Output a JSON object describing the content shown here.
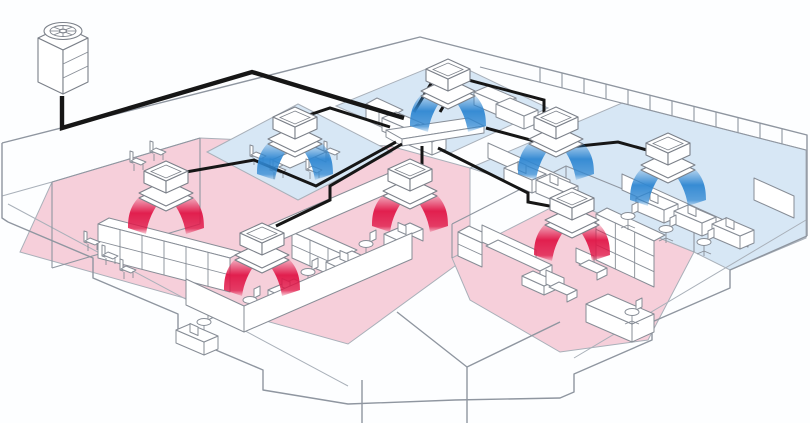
{
  "diagram": {
    "kind": "office-vrf-air-conditioning-isometric",
    "colors": {
      "bg": "#fdfeff",
      "line": "#8f96a0",
      "line_soft": "#a9b0b9",
      "furn_line": "#878d96",
      "furn_fill": "#ffffff",
      "pipe": "#161616",
      "cool_zone": "#d7e7f5",
      "heat_zone": "#f6cfda",
      "cool_air": "#2f87d2",
      "heat_air": "#e01647",
      "unit_body": "#ffffff",
      "unit_line": "#7b8089"
    },
    "building": {
      "outline": [
        "M2,143 L420,37 L807,135 L807,236",
        "M807,236 L730,270 L730,288 L652,322 L652,340 L574,374 L574,392 L560,398 L455,400",
        "M8,222 L93,258 L93,278 L178,314 L178,334 L263,370 L263,390 L348,404 L455,400",
        "M2,143 L2,218 L8,222",
        "M397,312 L467,367 L560,322",
        "M467,367 L467,423",
        "M362,380 L362,423"
      ],
      "outline_soft": [
        "M8,204 L348,386",
        "M806,220 L574,358",
        "M2,196 L52,182"
      ],
      "wall_lines": [
        "M52,182 L200,138",
        "M52,182 L52,268",
        "M200,138 L200,224",
        "M52,268 L200,224",
        "M452,224 L566,166 L694,218",
        "M452,224 L452,258",
        "M566,166 L566,200",
        "M694,218 L694,252",
        "M480,67 L806,150"
      ],
      "mullions": {
        "x_start": 540,
        "x_end": 792,
        "step": 22,
        "len": 15,
        "y0": 37,
        "x0": 420,
        "slope": 0.253
      }
    },
    "zones": [
      {
        "id": "heating-open-office",
        "mode": "heating",
        "points": "52,182 200,138 390,146 470,168 470,255 348,344 20,252"
      },
      {
        "id": "heating-lounge",
        "mode": "heating",
        "points": "452,258 566,200 694,252 648,340 560,352 470,300"
      },
      {
        "id": "cooling-meeting-room",
        "mode": "cooling",
        "points": "207,152 298,104 392,152 298,200"
      },
      {
        "id": "cooling-top-room",
        "mode": "cooling",
        "points": "336,106 448,60 548,108 448,154"
      },
      {
        "id": "cooling-right-wing",
        "mode": "cooling",
        "points": "470,168 622,103 806,150 806,238 730,270 694,252 566,200"
      }
    ],
    "outdoor_unit": {
      "x": 63,
      "y": 30
    },
    "manifold": {
      "top": "386,130 468,118 484,126 402,139",
      "front": "402,139 484,126 484,133 402,146",
      "side": "386,130 402,139 402,146 386,137"
    },
    "pipes": {
      "main": "M62,96 L62,128 L252,72 L404,118",
      "branches": [
        "M440,112 L452,92 L450,80",
        "M390,127 L330,108 L300,118",
        "M414,112 L438,72 L544,100 L544,114 L556,122",
        "M486,128 L560,148 L618,142 L654,152",
        "M396,142 L316,186 L254,160 L186,172",
        "M402,144 L330,186 L330,200 L276,226",
        "M422,146 L422,166 L414,170",
        "M438,148 L528,193 L528,202 L560,208"
      ]
    },
    "indoor_units": [
      {
        "id": "u1",
        "mode": "cooling",
        "x": 448,
        "y": 86
      },
      {
        "id": "u2",
        "mode": "cooling",
        "x": 295,
        "y": 134
      },
      {
        "id": "u3",
        "mode": "cooling",
        "x": 556,
        "y": 134
      },
      {
        "id": "u4",
        "mode": "cooling",
        "x": 668,
        "y": 160
      },
      {
        "id": "u5",
        "mode": "heating",
        "x": 166,
        "y": 188
      },
      {
        "id": "u6",
        "mode": "heating",
        "x": 262,
        "y": 250
      },
      {
        "id": "u7",
        "mode": "heating",
        "x": 410,
        "y": 186
      },
      {
        "id": "u8",
        "mode": "heating",
        "x": 572,
        "y": 215
      }
    ],
    "furniture": [
      {
        "t": "shelf",
        "x": 98,
        "y": 224,
        "dx": 132,
        "dy": 34,
        "h": 34,
        "c": 6,
        "r": 2
      },
      {
        "t": "shelf",
        "x": 292,
        "y": 232,
        "dx": 54,
        "dy": 24,
        "h": 26,
        "c": 3,
        "r": 2
      },
      {
        "t": "shelf",
        "x": 596,
        "y": 214,
        "dx": 58,
        "dy": 27,
        "h": 46,
        "c": 3,
        "r": 3
      },
      {
        "t": "shelf",
        "x": 458,
        "y": 232,
        "dx": 24,
        "dy": 11,
        "h": 24,
        "c": 1,
        "r": 2
      },
      {
        "t": "shelf",
        "x": 366,
        "y": 104,
        "dx": 26,
        "dy": 12,
        "h": 16,
        "c": 2,
        "r": 1
      },
      {
        "t": "panel",
        "x": 244,
        "y": 332,
        "dx": 168,
        "dy": -73,
        "h": 26
      },
      {
        "t": "panel",
        "x": 244,
        "y": 332,
        "dx": -58,
        "dy": -27,
        "h": 26
      },
      {
        "t": "panel",
        "x": 258,
        "y": 250,
        "dx": 138,
        "dy": -60,
        "h": 20
      },
      {
        "t": "panel",
        "x": 622,
        "y": 190,
        "dx": 126,
        "dy": 57,
        "h": 16
      },
      {
        "t": "panel",
        "x": 754,
        "y": 200,
        "dx": 40,
        "dy": 18,
        "h": 22
      },
      {
        "t": "panel",
        "x": 488,
        "y": 158,
        "dx": 82,
        "dy": 37,
        "h": 15
      },
      {
        "t": "desk",
        "x": 268,
        "y": 290
      },
      {
        "t": "desk",
        "x": 326,
        "y": 262
      },
      {
        "t": "desk",
        "x": 384,
        "y": 234
      },
      {
        "t": "desk2",
        "x": 636,
        "y": 198,
        "m": 1
      },
      {
        "t": "desk2",
        "x": 674,
        "y": 211,
        "m": 1
      },
      {
        "t": "desk2",
        "x": 712,
        "y": 224,
        "m": 1
      },
      {
        "t": "desk2",
        "x": 504,
        "y": 168,
        "m": 1
      },
      {
        "t": "desk2",
        "x": 536,
        "y": 180,
        "m": 1
      },
      {
        "t": "desk2",
        "x": 382,
        "y": 118
      },
      {
        "t": "desk2",
        "x": 404,
        "y": 130
      },
      {
        "t": "desk2",
        "x": 474,
        "y": 92
      },
      {
        "t": "desk2",
        "x": 496,
        "y": 104
      },
      {
        "t": "desk2",
        "x": 176,
        "y": 330,
        "m": 1
      },
      {
        "t": "deskL",
        "x": 586,
        "y": 304
      },
      {
        "t": "table",
        "x": 272,
        "y": 160
      },
      {
        "t": "table2",
        "x": 522,
        "y": 276
      },
      {
        "t": "sofa",
        "x": 482,
        "y": 242
      },
      {
        "t": "armchair",
        "x": 546,
        "y": 284
      },
      {
        "t": "armchair",
        "x": 576,
        "y": 262
      },
      {
        "t": "chair",
        "x": 84,
        "y": 242
      },
      {
        "t": "chair",
        "x": 102,
        "y": 256
      },
      {
        "t": "chair",
        "x": 120,
        "y": 270
      },
      {
        "t": "chair",
        "x": 130,
        "y": 162
      },
      {
        "t": "chair",
        "x": 150,
        "y": 152
      },
      {
        "t": "chair",
        "x": 250,
        "y": 156
      },
      {
        "t": "chair",
        "x": 270,
        "y": 170
      },
      {
        "t": "chair",
        "x": 306,
        "y": 170
      },
      {
        "t": "chair",
        "x": 324,
        "y": 152
      },
      {
        "t": "swivel",
        "x": 250,
        "y": 300
      },
      {
        "t": "swivel",
        "x": 308,
        "y": 272
      },
      {
        "t": "swivel",
        "x": 366,
        "y": 244
      },
      {
        "t": "swivel",
        "x": 628,
        "y": 216
      },
      {
        "t": "swivel",
        "x": 666,
        "y": 229
      },
      {
        "t": "swivel",
        "x": 704,
        "y": 242
      },
      {
        "t": "swivel",
        "x": 204,
        "y": 322
      },
      {
        "t": "swivel",
        "x": 632,
        "y": 312
      }
    ]
  }
}
